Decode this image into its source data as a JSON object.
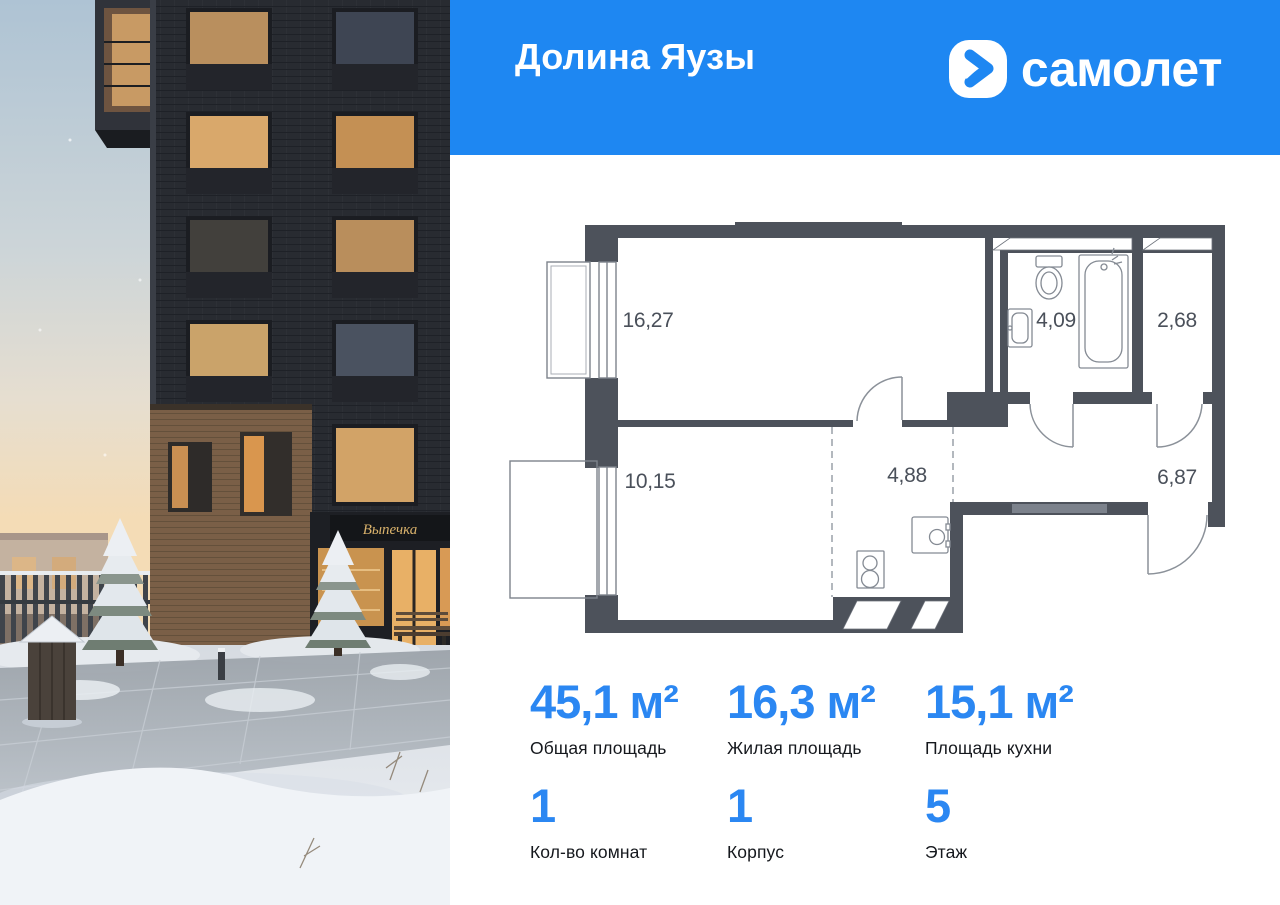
{
  "header": {
    "project_name": "Долина Яузы",
    "brand_name": "самолет"
  },
  "colors": {
    "accent_blue": "#1e87f2",
    "stat_number_blue": "#2b87f2",
    "plan_wall": "#4d525b"
  },
  "photo": {
    "shop_sign": "Выпечка"
  },
  "floor_plan": {
    "rooms": [
      {
        "id": "living",
        "area": "16,27"
      },
      {
        "id": "bathroom",
        "area": "4,09"
      },
      {
        "id": "storage",
        "area": "2,68"
      },
      {
        "id": "bedroom",
        "area": "10,15"
      },
      {
        "id": "kitchen",
        "area": "4,88"
      },
      {
        "id": "hallway",
        "area": "6,87"
      }
    ]
  },
  "stats": [
    {
      "value": "45,1 м²",
      "label": "Общая площадь"
    },
    {
      "value": "16,3 м²",
      "label": "Жилая площадь"
    },
    {
      "value": "15,1 м²",
      "label": "Площадь кухни"
    },
    {
      "value": "1",
      "label": "Кол-во комнат"
    },
    {
      "value": "1",
      "label": "Корпус"
    },
    {
      "value": "5",
      "label": "Этаж"
    }
  ]
}
